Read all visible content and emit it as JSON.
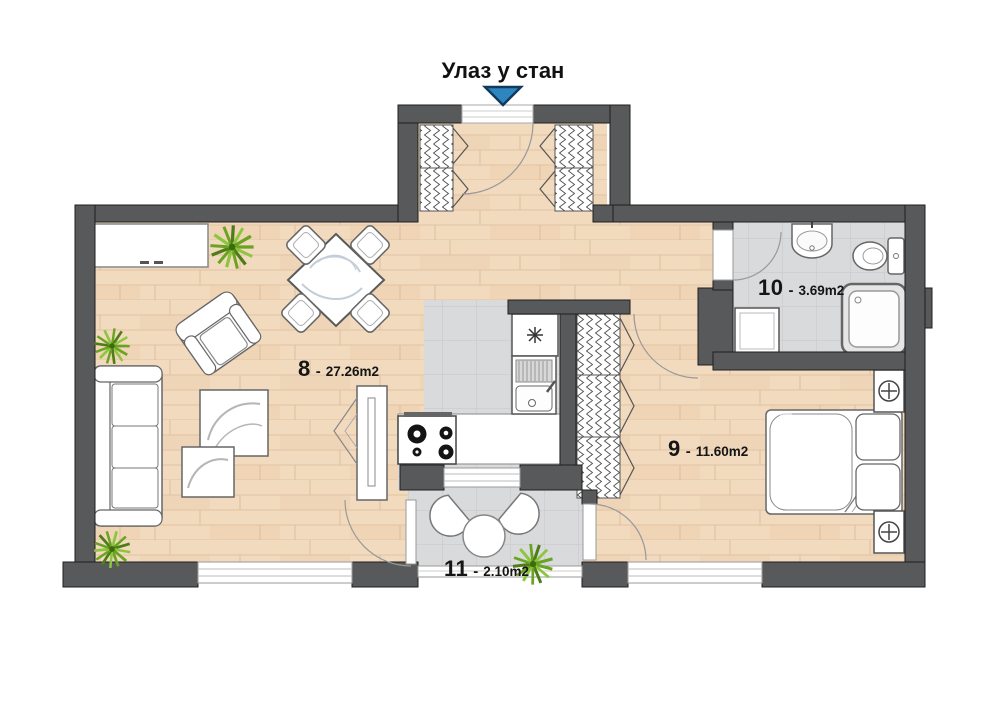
{
  "title": {
    "text": "Улаз у стан"
  },
  "separator": "-",
  "rooms": [
    {
      "number": "8",
      "area": "27.26m2"
    },
    {
      "number": "9",
      "area": "11.60m2"
    },
    {
      "number": "10",
      "area": "3.69m2"
    },
    {
      "number": "11",
      "area": "2.10m2"
    }
  ],
  "watermark": "obe",
  "colors": {
    "wall": "#58595b",
    "wood_floor": "#f2dabf",
    "tile_floor": "#d9dadb",
    "entrance_arrow": "#2e86c1",
    "plant": "#6aa321"
  },
  "icons": [
    "entrance-arrow"
  ]
}
